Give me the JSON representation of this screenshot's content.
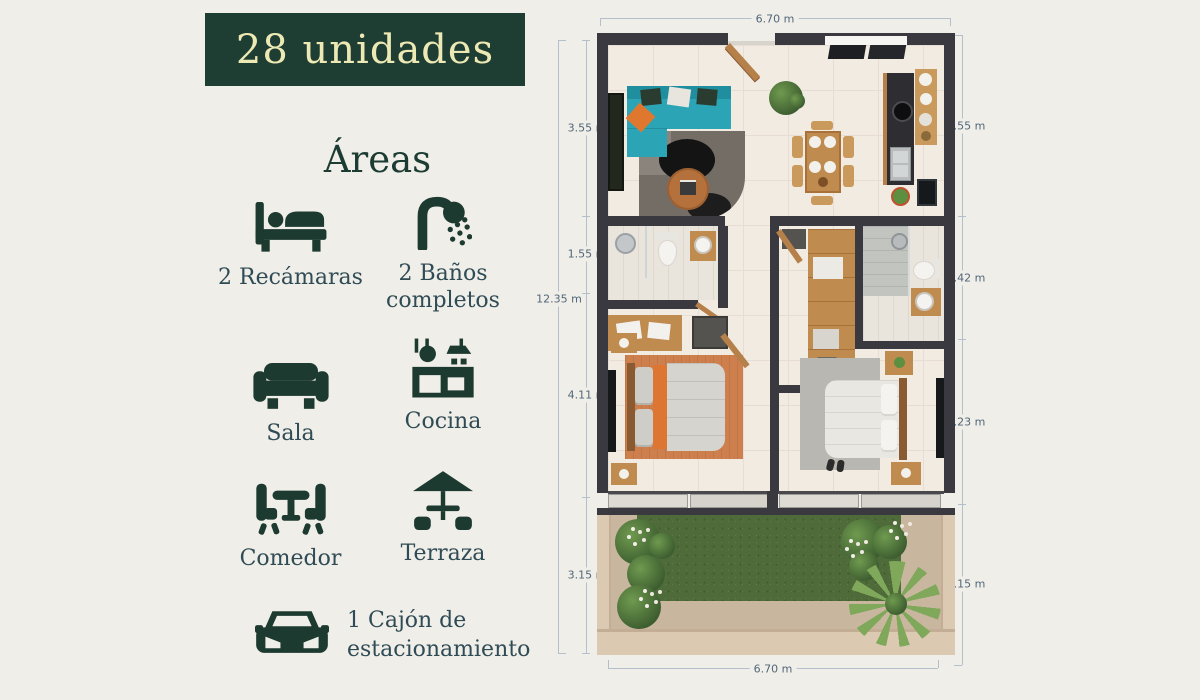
{
  "badge": {
    "label": "28 unidades"
  },
  "areas": {
    "title": "Áreas",
    "features": [
      {
        "icon": "bed-icon",
        "label": "2 Recámaras"
      },
      {
        "icon": "shower-icon",
        "label": "2 Baños completos"
      },
      {
        "icon": "sofa-icon",
        "label": "Sala"
      },
      {
        "icon": "kitchen-icon",
        "label": "Cocina"
      },
      {
        "icon": "dining-icon",
        "label": "Comedor"
      },
      {
        "icon": "terrace-icon",
        "label": "Terraza"
      }
    ],
    "parking": {
      "icon": "car-icon",
      "label": "1 Cajón de estacionamiento"
    }
  },
  "floor_plan": {
    "dimensions": {
      "top": "6.70 m",
      "bottom": "6.70 m",
      "left_total": "12.35 m",
      "left_segments": [
        "3.55 m",
        "1.55 m",
        "4.11 m",
        "3.15 m"
      ],
      "right_segments": [
        "3.55 m",
        "2.42 m",
        "3.23 m",
        "3.15 m"
      ]
    }
  },
  "colors": {
    "page_bg": "#f0eee8",
    "badge_bg": "#1e3d33",
    "badge_text": "#ede9b4",
    "icon_green": "#1d3a31",
    "label_text": "#2f4b55",
    "dimension_text": "#51677a",
    "dimension_line": "#b3bfca",
    "plan_wall": "#3a393f",
    "sofa_teal": "#2ba4b5",
    "accent_orange": "#e0772f",
    "wood": "#c08b4f",
    "grass_green": "#4e6b39"
  }
}
